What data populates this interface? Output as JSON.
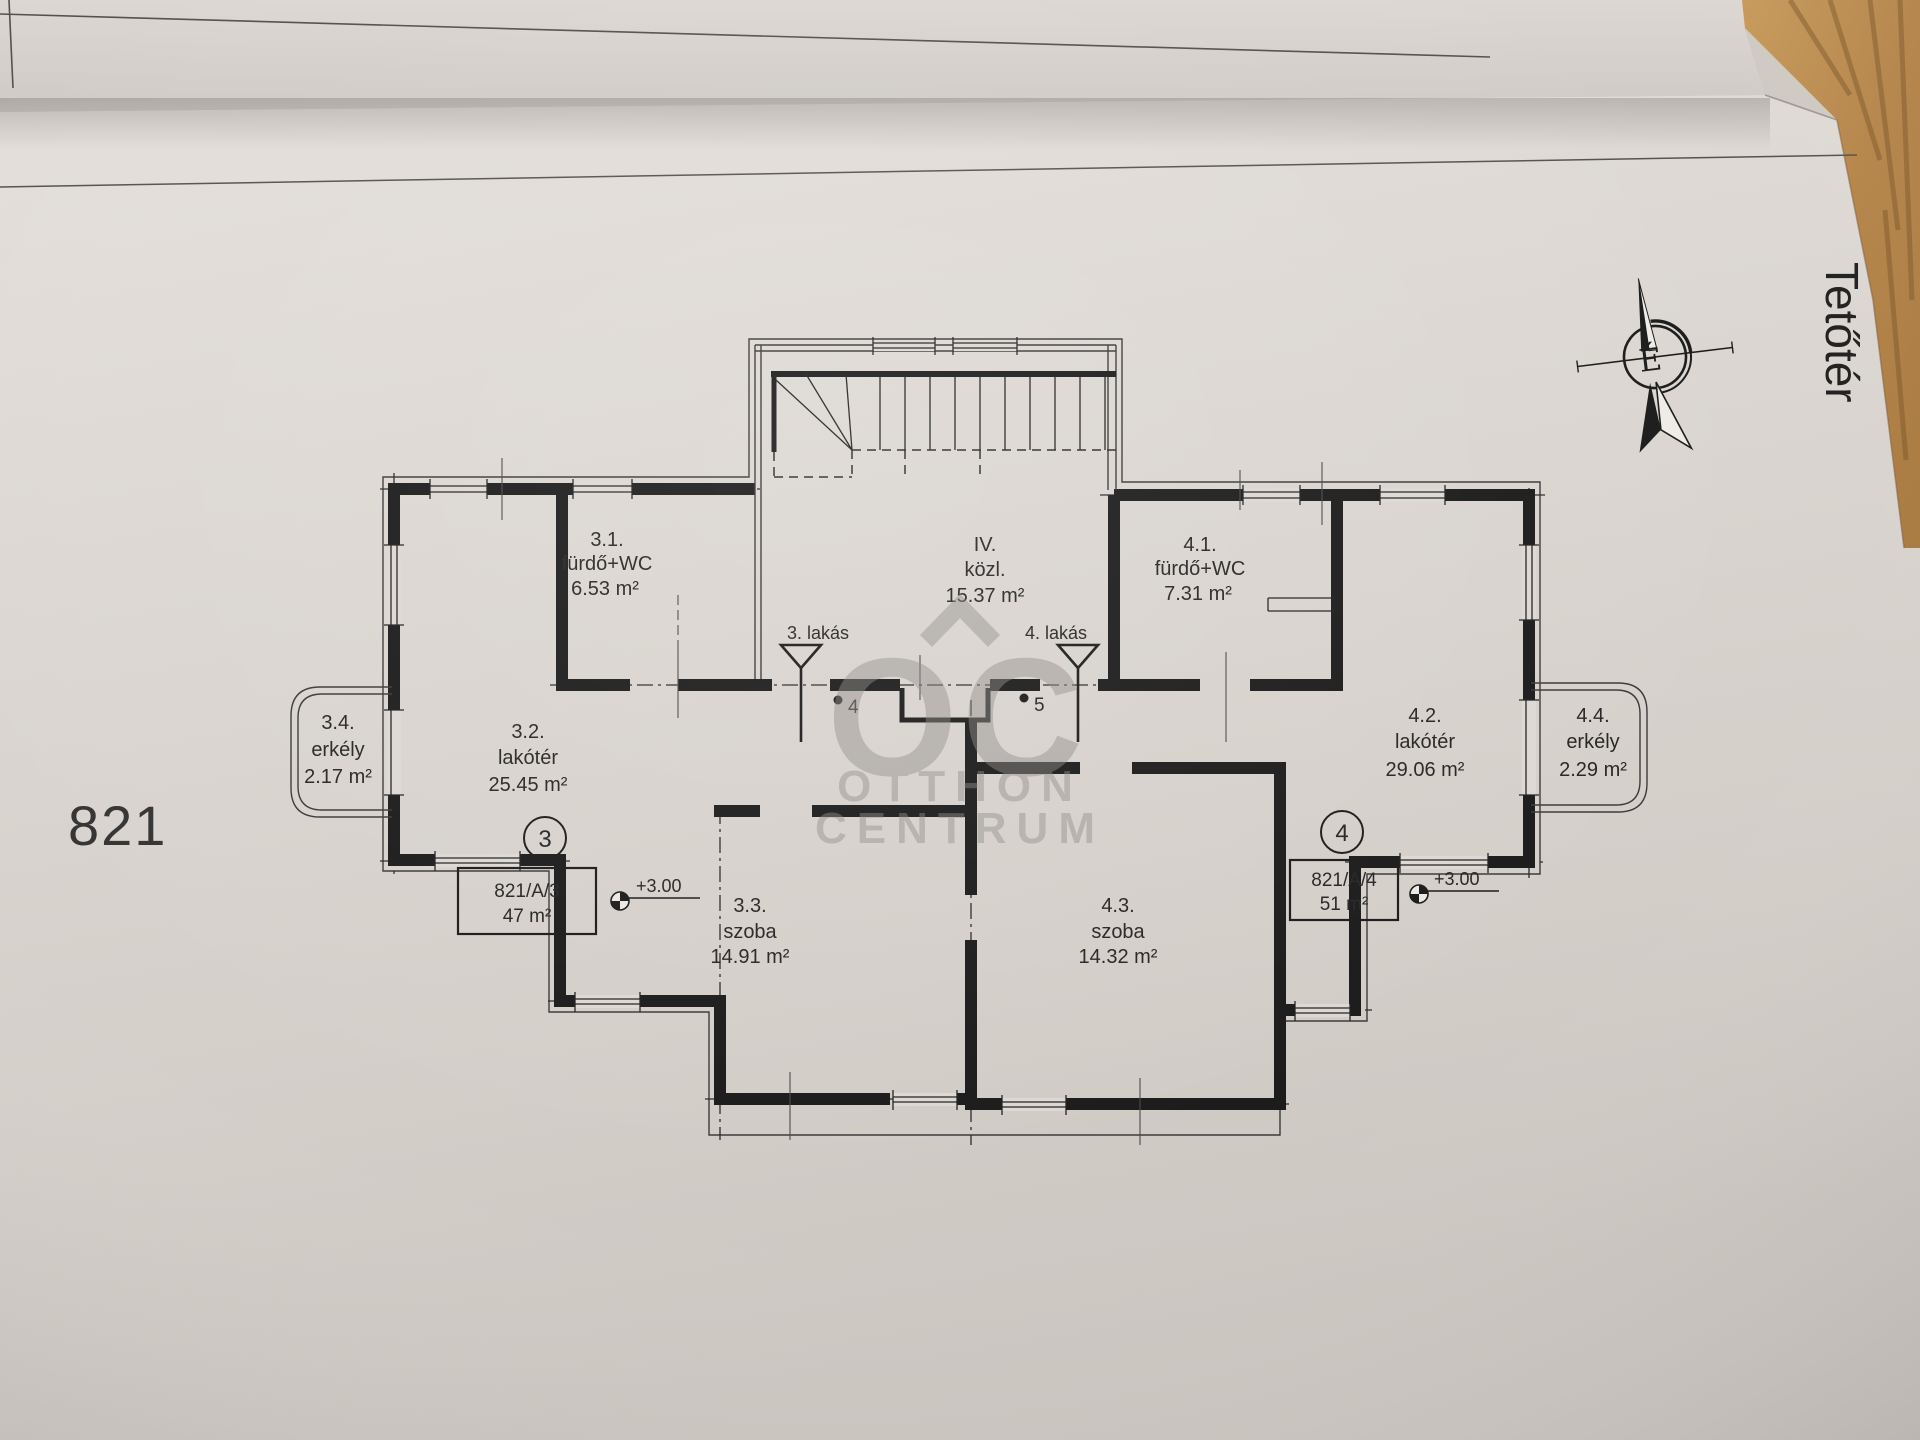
{
  "meta": {
    "plot_number": "821",
    "floor_title": "Tetőtér",
    "compass_letter": "É"
  },
  "watermark": {
    "logo": "OC",
    "line1": "OTTHON",
    "line2": "CENTRUM"
  },
  "hall": {
    "num": "IV.",
    "name": "közl.",
    "area": "15.37 m²"
  },
  "u3": {
    "entrance": "3. lakás",
    "survey_point": "4",
    "badge": "3",
    "parcel": "821/A/3",
    "size": "47 m²",
    "elevation": "+3.00",
    "bath": {
      "num": "3.1.",
      "name": "fürdő+WC",
      "area": "6.53 m²"
    },
    "living": {
      "num": "3.2.",
      "name": "lakótér",
      "area": "25.45 m²"
    },
    "room": {
      "num": "3.3.",
      "name": "szoba",
      "area": "14.91 m²"
    },
    "balcony": {
      "num": "3.4.",
      "name": "erkély",
      "area": "2.17 m²"
    }
  },
  "u4": {
    "entrance": "4. lakás",
    "survey_point": "5",
    "badge": "4",
    "parcel": "821/A/4",
    "size": "51 m²",
    "elevation": "+3.00",
    "bath": {
      "num": "4.1.",
      "name": "fürdő+WC",
      "area": "7.31 m²"
    },
    "living": {
      "num": "4.2.",
      "name": "lakótér",
      "area": "29.06 m²"
    },
    "room": {
      "num": "4.3.",
      "name": "szoba",
      "area": "14.32 m²"
    },
    "balcony": {
      "num": "4.4.",
      "name": "erkély",
      "area": "2.29 m²"
    }
  }
}
